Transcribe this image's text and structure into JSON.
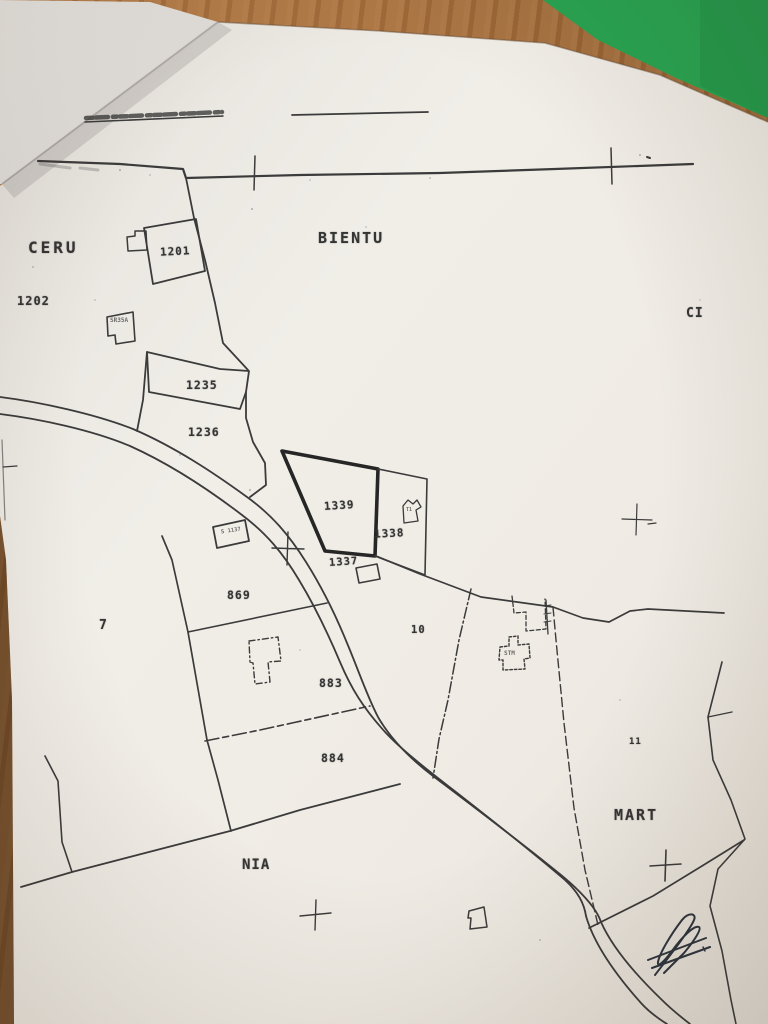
{
  "map": {
    "regions": {
      "ceru": "CERU",
      "bientu": "BIENTU",
      "ci": "CI",
      "mart": "MART",
      "nia": "NIA"
    },
    "parcels": {
      "p1202": "1202",
      "p1201": "1201",
      "p1235": "1235",
      "p1236": "1236",
      "p1339": "1339",
      "p1338": "1338",
      "p1337": "1337",
      "p869": "869",
      "p883": "883",
      "p884": "884",
      "p7": "7",
      "p10": "10",
      "p11": "11"
    },
    "buildings": {
      "b_sr35a": "SR35A",
      "b_s1137": "S 1137",
      "b_stm": "STM",
      "b_t1": "T1"
    },
    "symbols": {
      "survey_cross": "survey-cross-icon",
      "signature": "handwritten-signature"
    }
  },
  "colors": {
    "table_wood": "#a9713f",
    "folder_green": "#27a451",
    "paper": "#efece7",
    "ink": "#3b3b3b",
    "pen_ink": "#1c2531"
  }
}
